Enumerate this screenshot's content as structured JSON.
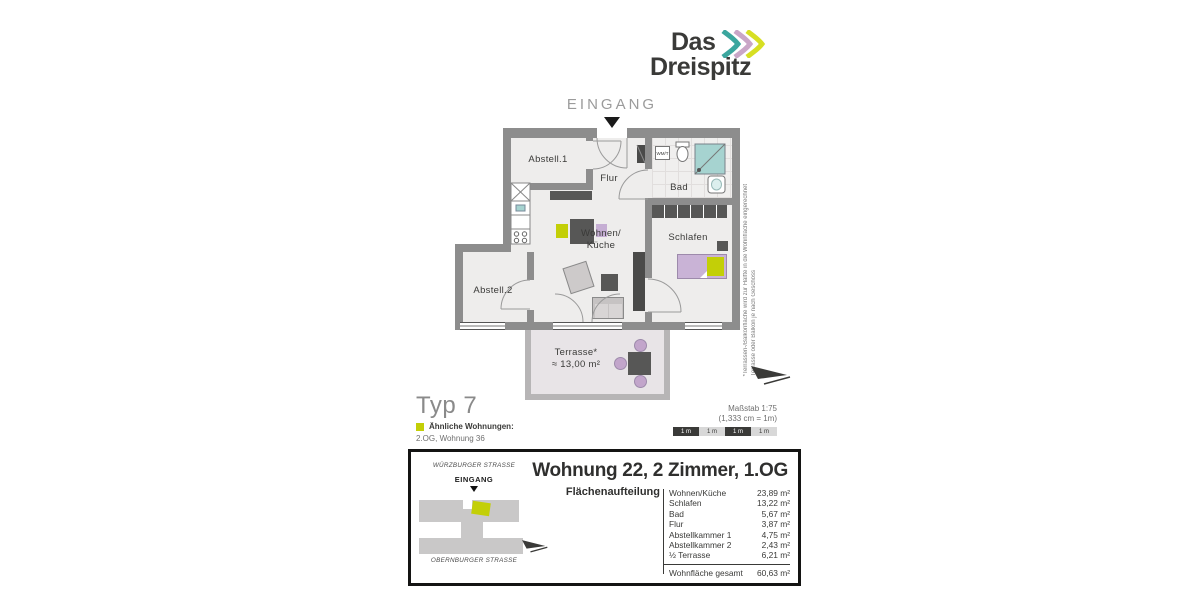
{
  "brand": {
    "name_line1": "Das",
    "name_line2": "Dreispitz"
  },
  "plan": {
    "entrance_label": "EINGANG",
    "rooms": {
      "abstell1": "Abstell.1",
      "flur": "Flur",
      "bad": "Bad",
      "wm": "WM/T",
      "wohnen_line1": "Wohnen/",
      "wohnen_line2": "Küche",
      "schlafen": "Schlafen",
      "abstell2": "Abstell.2",
      "terrasse_line1": "Terrasse*",
      "terrasse_line2": "≈ 13,00 m²"
    },
    "footnote_line1": "*Terrassen-/Balkonfläche wird zur Hälfte in die Wohnfläche eingerechnet",
    "footnote_line2": "Terrasse oder Balkon je nach Geschoss",
    "type_label": "Typ 7",
    "similar_title": "Ähnliche Wohnungen:",
    "similar_value": "2.OG, Wohnung 36",
    "scale_label": "Maßstab 1:75",
    "scale_conversion": "(1,333 cm = 1m)",
    "scale_segments": [
      "1 m",
      "1 m",
      "1 m",
      "1 m"
    ]
  },
  "info_box": {
    "minimap": {
      "street_top": "WÜRZBURGER STRASSE",
      "entrance": "EINGANG",
      "street_bottom": "OBERNBURGER STRASSE"
    },
    "title": "Wohnung 22, 2 Zimmer, 1.OG",
    "table_title": "Flächenaufteilung",
    "rows": [
      {
        "label": "Wohnen/Küche",
        "value": "23,89 m²"
      },
      {
        "label": "Schlafen",
        "value": "13,22 m²"
      },
      {
        "label": "Bad",
        "value": "5,67 m²"
      },
      {
        "label": "Flur",
        "value": "3,87 m²"
      },
      {
        "label": "Abstellkammer 1",
        "value": "4,75 m²"
      },
      {
        "label": "Abstellkammer 2",
        "value": "2,43 m²"
      },
      {
        "label": "½ Terrasse",
        "value": "6,21 m²"
      }
    ],
    "total": {
      "label": "Wohnfläche gesamt",
      "value": "60,63 m²"
    }
  },
  "colors": {
    "brand_teal": "#3ba69e",
    "brand_lavender": "#c9a6c7",
    "brand_yellow": "#d7df23",
    "accent_yellow": "#c3cf07",
    "furniture_lavender": "#c9b3d6",
    "wall_gray": "#8d8d8d",
    "furniture_dark": "#575756",
    "text_dark": "#3a3a38"
  }
}
